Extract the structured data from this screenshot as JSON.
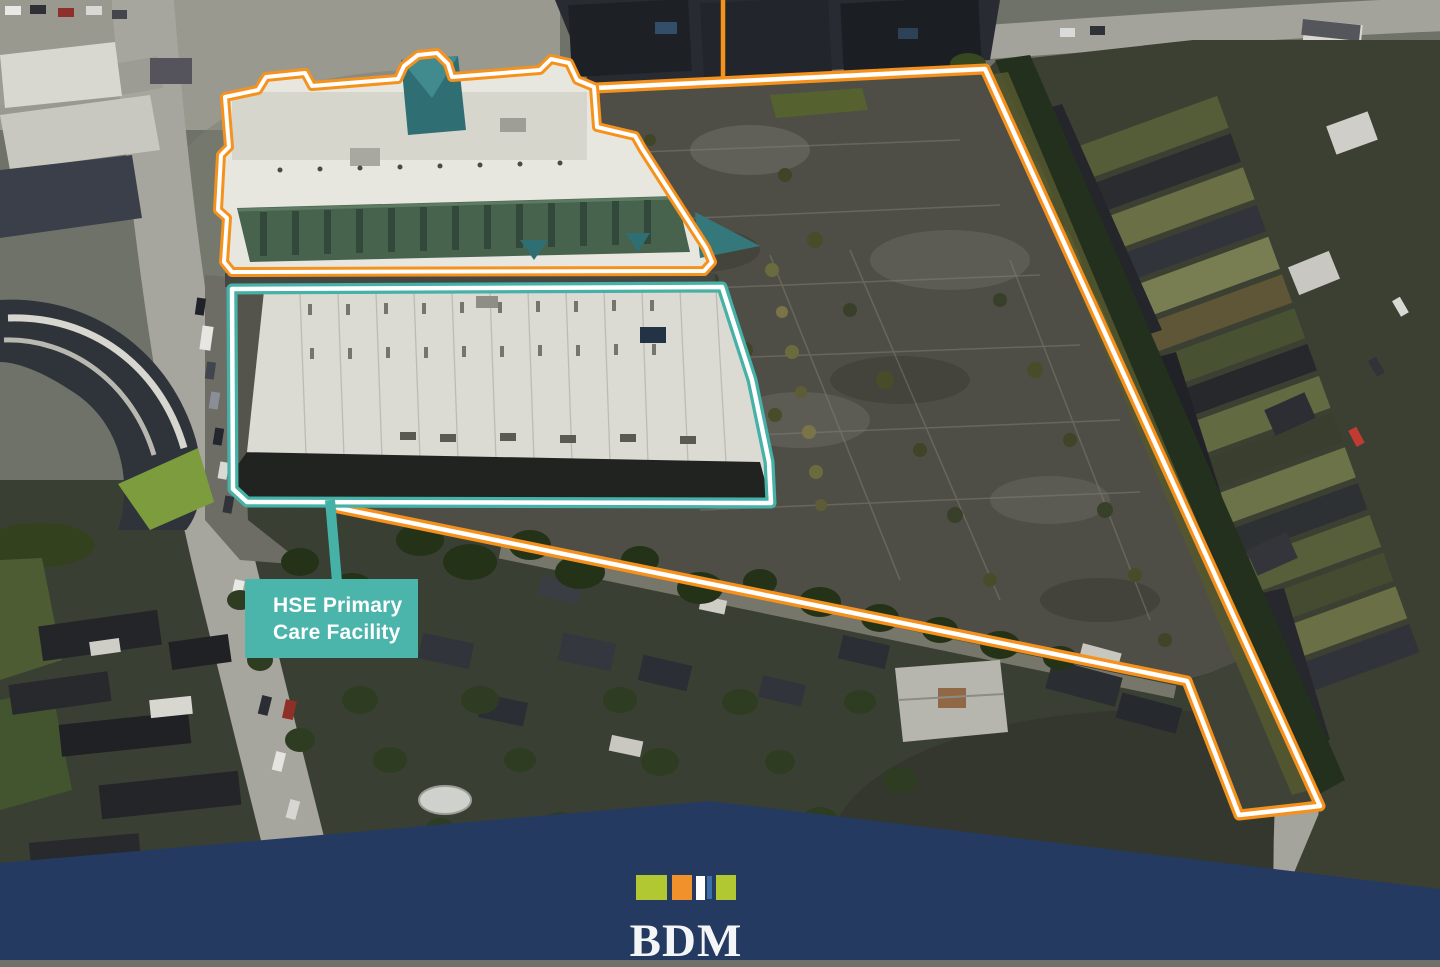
{
  "annotations": {
    "site_label": {
      "line1": "HSE Primary",
      "line2": "Care Facility"
    },
    "boundaries": [
      {
        "name": "development-site-boundary",
        "color": "#f5921e",
        "inner_line": "#ffffff"
      },
      {
        "name": "retail-building-outline",
        "color": "#f5921e",
        "inner_line": "#ffffff"
      },
      {
        "name": "hse-primary-care-facility-outline",
        "color": "#45b1a7",
        "inner_line": "#ffffff"
      }
    ],
    "label_background": "#4bb4ab",
    "label_text_color": "#ffffff"
  },
  "branding": {
    "logo_text": "BDM",
    "banner_color": "#253a61",
    "logo_text_color": "#f4f5f7",
    "logo_squares": [
      {
        "name": "lime-square",
        "color": "#b2c832"
      },
      {
        "name": "orange-square",
        "color": "#f0912b"
      },
      {
        "name": "white-square",
        "color": "#ffffff"
      },
      {
        "name": "blue-square",
        "color": "#3c6fa8"
      },
      {
        "name": "lime-square-2",
        "color": "#b2c832"
      }
    ]
  },
  "colors": {
    "boundary_orange": "#f5921e",
    "outline_teal": "#45b1a7",
    "banner_navy": "#253a61",
    "asphalt": "#4f4e46",
    "road_gray": "#a7a69e"
  }
}
